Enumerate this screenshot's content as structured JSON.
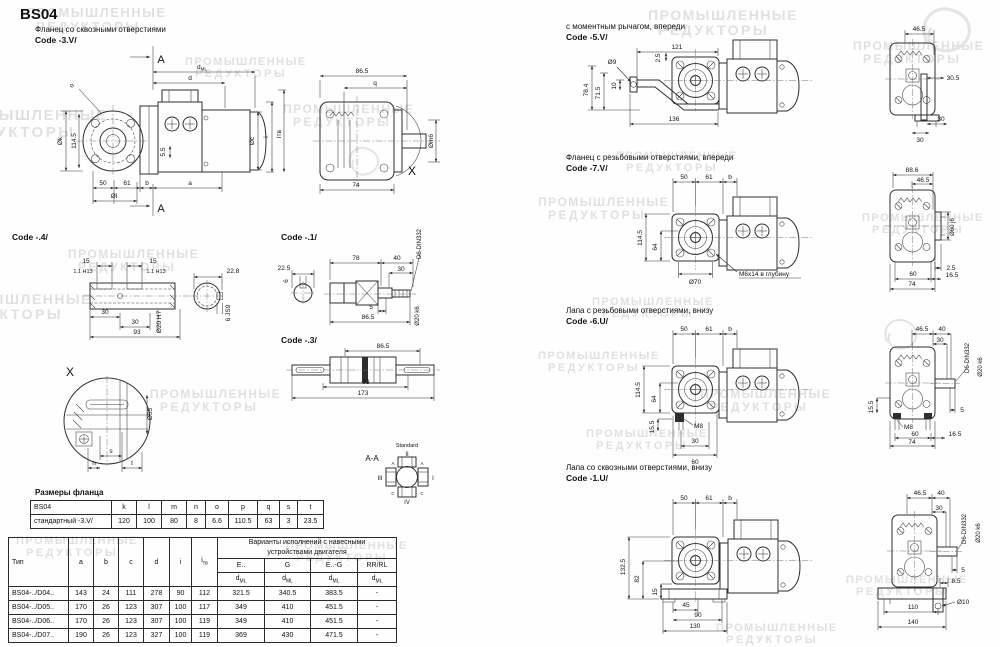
{
  "page_title": "BS04",
  "watermark": {
    "line1": "ПРОМЫШЛЕННЫЕ",
    "line2": "РЕДУКТОРЫ"
  },
  "sections": {
    "flange_through": {
      "caption": "Фланец со сквозными отверстиями",
      "code": "Code -3.V/"
    },
    "code4": {
      "code": "Code -.4/"
    },
    "code1": {
      "code": "Code -.1/"
    },
    "code3": {
      "code": "Code -.3/"
    },
    "torque_arm": {
      "caption": "с моментным рычагом, впереди",
      "code": "Code -5.V/"
    },
    "flange_tapped": {
      "caption": "Фланец с резьбовыми отверстиями, впереди",
      "code": "Code -7.V/"
    },
    "foot_tapped": {
      "caption": "Лапа с резьбовыми отверстиями, внизу",
      "code": "Code -6.U/"
    },
    "foot_through": {
      "caption": "Лапа со сквозными отверстиями, внизу",
      "code": "Code -1.U/"
    }
  },
  "dims": {
    "main": {
      "section": "A",
      "dml_base": "d",
      "dml_sub": "ML",
      "d": "d",
      "o": "o",
      "ok": "Øk",
      "h114": "114.5",
      "w50": "50",
      "w61": "61",
      "b": "b",
      "a": "a",
      "ol": "Øl",
      "h55": "5.5",
      "oc": "Øc",
      "i": "i",
      "itv": "iтв"
    },
    "mside": {
      "w86": "86.5",
      "q": "q",
      "om": "Øm6",
      "w74": "74",
      "x": "X"
    },
    "c4": {
      "w15": "15",
      "fit11": "1.1 H13",
      "w228": "22.8",
      "w30": "30",
      "w93": "93",
      "o20": "Ø20 H7",
      "key": "6 JS9"
    },
    "c1": {
      "w225": "22.5",
      "w6": "6",
      "w78": "78",
      "w40": "40",
      "w30": "30",
      "din": "D6-DIN332",
      "w5": "5",
      "w86": "86.5",
      "o20": "Ø20 k6"
    },
    "c3": {
      "w86": "86.5",
      "w93": "93",
      "w173": "173"
    },
    "xd": {
      "x": "X",
      "o55": "Ø55",
      "s": "s",
      "n": "n",
      "t": "t"
    },
    "aa": {
      "label": "A-A",
      "std": "Standard",
      "p1": "I",
      "p2": "II",
      "p3": "III",
      "p4": "IV",
      "ta": "A",
      "tc": "C"
    },
    "s5": {
      "w121": "121",
      "o9": "Ø9",
      "h25": "2.5",
      "h78": "78.4",
      "h71": "71.5",
      "h10": "10",
      "w136": "136",
      "w46": "46.5",
      "w305": "30.5",
      "w30": "30"
    },
    "s7": {
      "w50": "50",
      "w61": "61",
      "b": "b",
      "h114": "114.5",
      "h64": "64",
      "o70": "Ø70",
      "tap": "М6х14 в глубину",
      "w88": "88.6",
      "w46": "46.5",
      "o60": "Ø60 j6",
      "h25": "2.5",
      "w60": "60",
      "w165": "16.5",
      "w74": "74"
    },
    "s6": {
      "w50": "50",
      "w61": "61",
      "b": "b",
      "h114": "114.5",
      "h64": "64",
      "m8": "M8",
      "h155": "15.5",
      "w30": "30",
      "w60": "60",
      "w46": "46.5",
      "w40": "40",
      "din": "D6-DIN332",
      "o20": "Ø20 k6",
      "w5": "5",
      "w165": "16.5",
      "w74": "74"
    },
    "s1": {
      "w50": "50",
      "w61": "61",
      "b": "b",
      "h132": "132.5",
      "h82": "82",
      "h15": "15",
      "w45": "45",
      "w90": "90",
      "w130": "130",
      "w46": "46.5",
      "w40": "40",
      "w30": "30",
      "din": "D6-DIN332",
      "o20": "Ø20 k6",
      "w5": "5",
      "w85": "8.5",
      "o10": "Ø10",
      "w110": "110",
      "w140": "140"
    }
  },
  "flange_table": {
    "title": "Размеры фланца",
    "header": [
      "BS04",
      "k",
      "l",
      "m",
      "n",
      "o",
      "p",
      "q",
      "s",
      "t"
    ],
    "rows": [
      [
        "стандартный -3.V/",
        "120",
        "100",
        "80",
        "8",
        "6.6",
        "110.5",
        "63",
        "3",
        "23.5"
      ]
    ]
  },
  "variants_table": {
    "group_header_1": "Варианты исполнений с навесными",
    "group_header_2": "устройствами двигателя",
    "cols": [
      "Тип",
      "a",
      "b",
      "c",
      "d",
      "i"
    ],
    "col_itv_base": "i",
    "col_itv_sub": "тв",
    "group_cols": [
      "E..",
      "G",
      "E..-G",
      "RR/RL"
    ],
    "dml_base": "d",
    "dml_sub": "ML",
    "rows": [
      [
        "BS04-../D04..",
        "143",
        "24",
        "111",
        "278",
        "90",
        "112",
        "321.5",
        "340.5",
        "383.5",
        "-"
      ],
      [
        "BS04-../D05..",
        "170",
        "26",
        "123",
        "307",
        "100",
        "117",
        "349",
        "410",
        "451.5",
        "-"
      ],
      [
        "BS04-../D06..",
        "170",
        "26",
        "123",
        "307",
        "100",
        "119",
        "349",
        "410",
        "451.5",
        "-"
      ],
      [
        "BS04-../D07..",
        "190",
        "26",
        "123",
        "327",
        "100",
        "119",
        "369",
        "430",
        "471.5",
        "-"
      ]
    ]
  }
}
